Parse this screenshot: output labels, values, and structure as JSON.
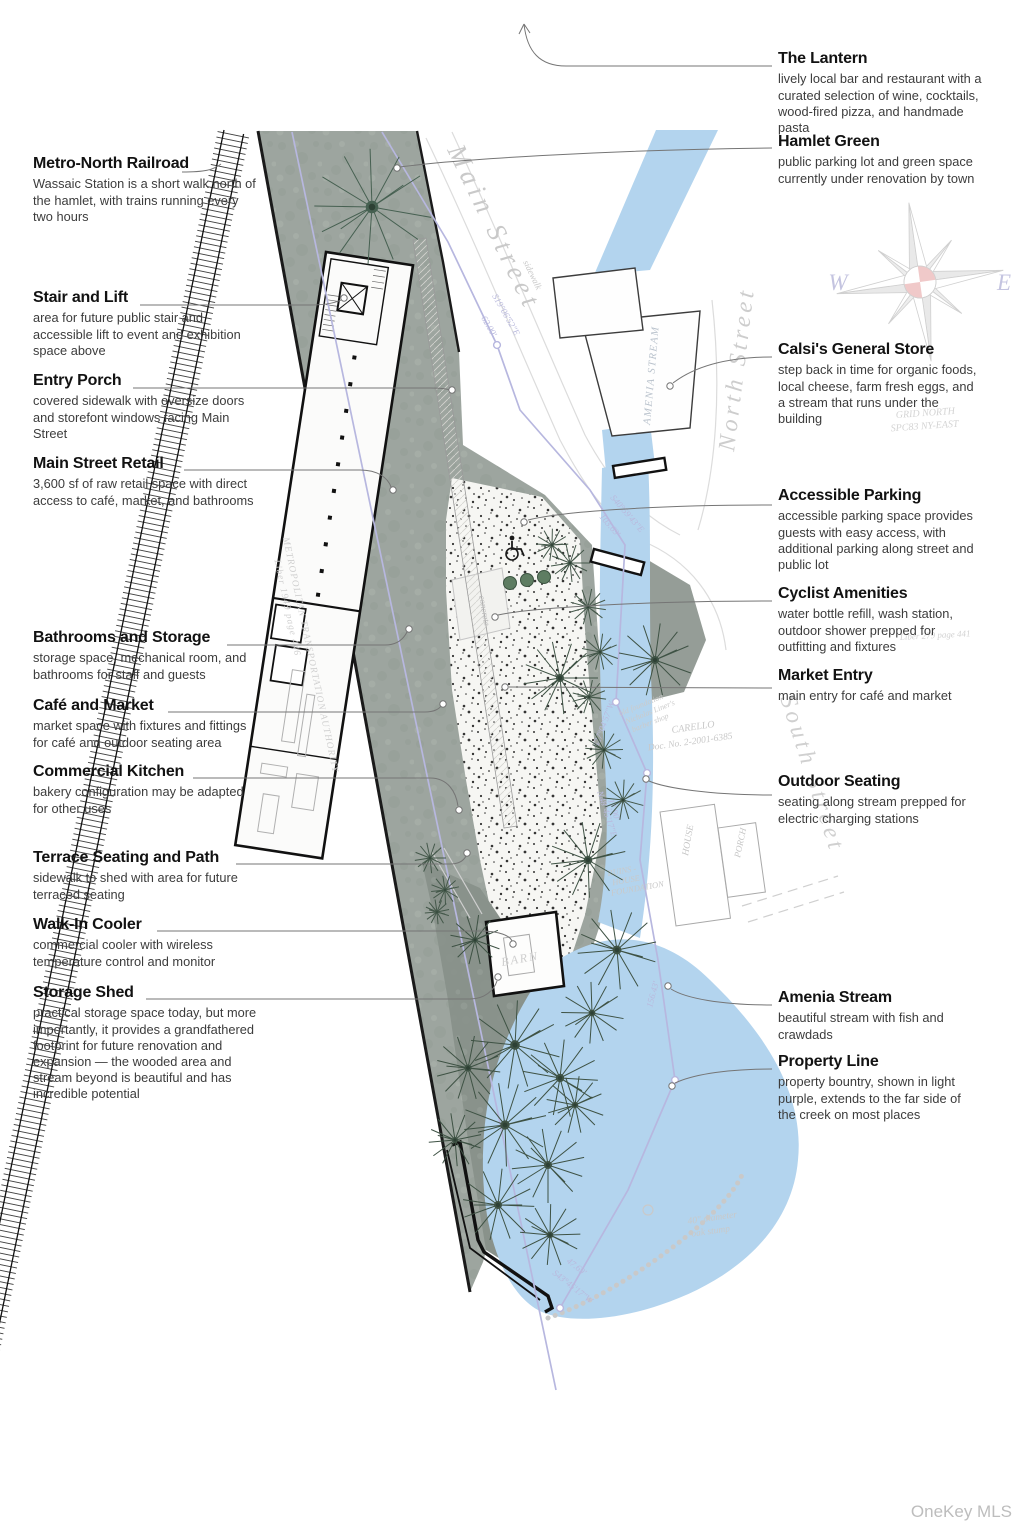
{
  "annotations": {
    "left": [
      {
        "title": "Metro-North Railroad",
        "body": "Wassaic Station is a short walk north of the hamlet, with trains running every two hours"
      },
      {
        "title": "Stair and Lift",
        "body": "area for future public stair and accessible lift to event and exhibition space above"
      },
      {
        "title": "Entry Porch",
        "body": "covered sidewalk with oversize doors and storefont windows facing Main Street"
      },
      {
        "title": "Main Street Retail",
        "body": "3,600 sf of raw retail space with direct access to café, market, and bathrooms"
      },
      {
        "title": "Bathrooms and Storage",
        "body": "storage space, mechanical room, and bathrooms for staff and guests"
      },
      {
        "title": "Café and Market",
        "body": "market space with fixtures and fittings for café and outdoor seating area"
      },
      {
        "title": "Commercial Kitchen",
        "body": "bakery configuration may be adapted for other uses"
      },
      {
        "title": "Terrace Seating and Path",
        "body": "sidewalk to shed with area for future terraced seating"
      },
      {
        "title": "Walk-In Cooler",
        "body": "commercial cooler with wireless temperature control and monitor"
      },
      {
        "title": "Storage Shed",
        "body": "practical storage space today, but more importantly, it provides a grandfathered footprint for future renovation and expansion — the wooded area and stream beyond is beautiful and has incredible potential"
      }
    ],
    "right": [
      {
        "title": "The Lantern",
        "body": "lively local bar and restaurant with a curated selection of wine, cocktails, wood-fired pizza, and handmade pasta"
      },
      {
        "title": "Hamlet Green",
        "body": "public parking lot and green space currently under renovation by town"
      },
      {
        "title": "Calsi's General Store",
        "body": "step back in time for organic foods, local cheese, farm fresh eggs, and a stream that runs under the building"
      },
      {
        "title": "Accessible Parking",
        "body": "accessible parking space provides guests with easy access, with additional parking along street and public lot"
      },
      {
        "title": "Cyclist Amenities",
        "body": "water bottle refill, wash station, outdoor shower prepped for outfitting and fixtures"
      },
      {
        "title": "Market Entry",
        "body": "main entry for café and market"
      },
      {
        "title": "Outdoor Seating",
        "body": "seating along stream prepped for electric charging stations"
      },
      {
        "title": "Amenia Stream",
        "body": "beautiful stream with fish and crawdads"
      },
      {
        "title": "Property Line",
        "body": "property bountry, shown in light purple, extends to the far side of the creek on most places"
      }
    ]
  },
  "map": {
    "streets": {
      "main": "Main Street",
      "north": "North Street",
      "south": "South Street"
    },
    "labels": {
      "amenia_stream": "AMENIA STREAM",
      "sidewalk": "sidewalk",
      "concrete": "concrete",
      "barn": "BARN",
      "house": "HOUSE",
      "porch": "PORCH",
      "ruins_1": "RUINS -",
      "ruins_2": "HOUSE",
      "ruins_3": "FOUNDATION",
      "mta": "METROPOLITAN TRANSPORTATION AUTHORITY",
      "mta_liber": "Liber 1949 page 446",
      "grid_north_1": "GRID NORTH",
      "grid_north_2": "SPC83 NY-EAST",
      "carello": "CARELLO",
      "carello_doc": "Doc. No. 2-2001-6385",
      "barber_1": "old foundation",
      "barber_2": "Nicholas Liner's",
      "barber_3": "barber shop",
      "liber_441": "Liber 279 page 441",
      "oak_1": "40\" diameter",
      "oak_2": "oak stump"
    },
    "bearings": {
      "b1": "S19°06'52\"E",
      "b1_len": "62.00'",
      "b2": "S40°59'43\"E",
      "b2_len": "103.69'",
      "b3": "N48°45'17\"E",
      "b3_len": "17.90'",
      "b4_len": "156.43'",
      "b5_len": "47.69'",
      "b5": "S43°45'17\"W",
      "b6": "S27°04'57\"W"
    }
  },
  "compass": {
    "w": "W",
    "e": "E"
  },
  "watermark": "OneKey MLS",
  "colors": {
    "stream": "#b3d4ee",
    "parcel": "#9da59f",
    "wooded": "#89928b",
    "stipple_bg": "#f6f6f3",
    "property_line": "#b7b7df",
    "tree": "#3e5244",
    "leader": "#757575",
    "compass_pink": "#f0c9c9"
  }
}
